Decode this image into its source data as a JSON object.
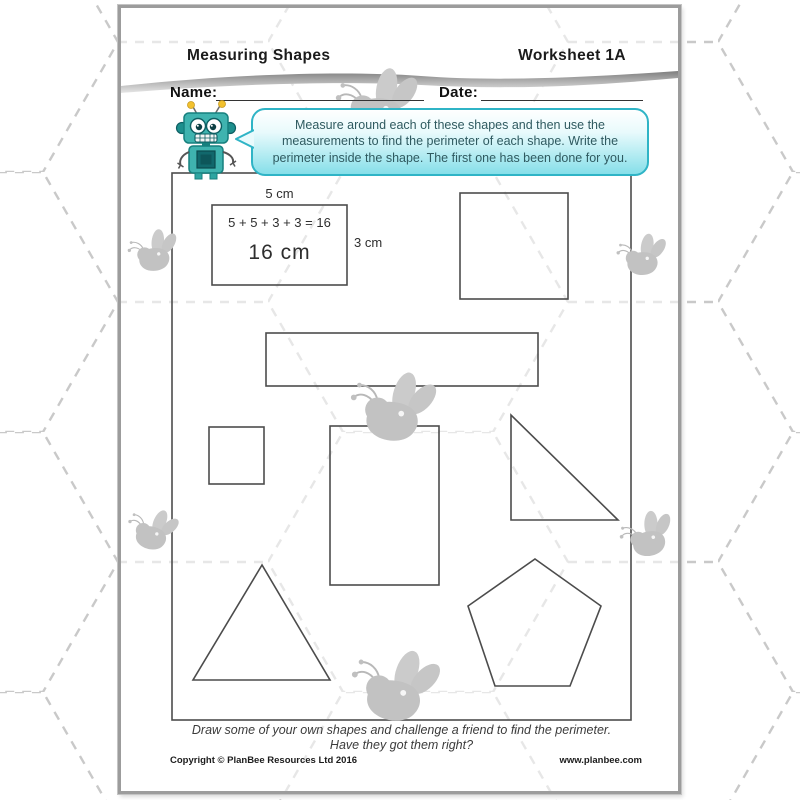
{
  "header": {
    "title": "Measuring Shapes",
    "worksheet_label": "Worksheet 1A"
  },
  "fields": {
    "name_label": "Name:",
    "date_label": "Date:"
  },
  "speech_bubble": {
    "text": "Measure around each of these shapes and then use the measurements to find the perimeter of each shape. Write the perimeter inside the shape. The first one has been done for you."
  },
  "example": {
    "top_length": "5 cm",
    "side_length": "3 cm",
    "equation": "5 + 5 + 3 + 3 = 16",
    "perimeter": "16 cm"
  },
  "diagram": {
    "frame": {
      "x": 51,
      "y": 165,
      "w": 459,
      "h": 547
    },
    "shapes": [
      {
        "name": "example-rectangle",
        "type": "rect",
        "x": 91,
        "y": 197,
        "w": 135,
        "h": 80
      },
      {
        "name": "square",
        "type": "rect",
        "x": 339,
        "y": 185,
        "w": 108,
        "h": 106
      },
      {
        "name": "long-rectangle",
        "type": "rect",
        "x": 145,
        "y": 325,
        "w": 272,
        "h": 53
      },
      {
        "name": "small-square",
        "type": "rect",
        "x": 88,
        "y": 419,
        "w": 55,
        "h": 57
      },
      {
        "name": "tall-rectangle",
        "type": "rect",
        "x": 209,
        "y": 418,
        "w": 109,
        "h": 159
      },
      {
        "name": "right-triangle",
        "type": "polygon",
        "points": "390,407 390,512 497,512"
      },
      {
        "name": "equilateral-triangle",
        "type": "polygon",
        "points": "141,557 72,672 209,672"
      },
      {
        "name": "pentagon",
        "type": "polygon",
        "points": "414,551 480,598 449,678 374,678 347,598"
      }
    ]
  },
  "bees": [
    {
      "x": 210,
      "y": 62,
      "scale": 0.92,
      "rot": -6
    },
    {
      "x": 2,
      "y": 226,
      "scale": 0.56,
      "rot": -12
    },
    {
      "x": 492,
      "y": 228,
      "scale": 0.56,
      "rot": -8
    },
    {
      "x": 228,
      "y": 360,
      "scale": 0.95,
      "rot": 0
    },
    {
      "x": 8,
      "y": 496,
      "scale": 0.56,
      "rot": 6
    },
    {
      "x": 492,
      "y": 512,
      "scale": 0.6,
      "rot": -18
    },
    {
      "x": 230,
      "y": 636,
      "scale": 0.98,
      "rot": 2
    }
  ],
  "footer": {
    "prompt_line1": "Draw some of your own shapes and challenge a friend to find the perimeter.",
    "prompt_line2": "Have they got them right?",
    "copyright": "Copyright © PlanBee Resources Ltd 2016",
    "website": "www.planbee.com"
  },
  "colors": {
    "bubble_border": "#2fb4c6",
    "bubble_fill": "#86dfe9",
    "robot_teal": "#3fb3af",
    "robot_dark_teal": "#17807e",
    "antenna_yellow": "#f2c12e",
    "shape_stroke": "#4c4c4c",
    "hexagon_line": "#c9c9c9",
    "bee_gray": "#c2c2c2",
    "page_border": "#9c9c9c"
  }
}
